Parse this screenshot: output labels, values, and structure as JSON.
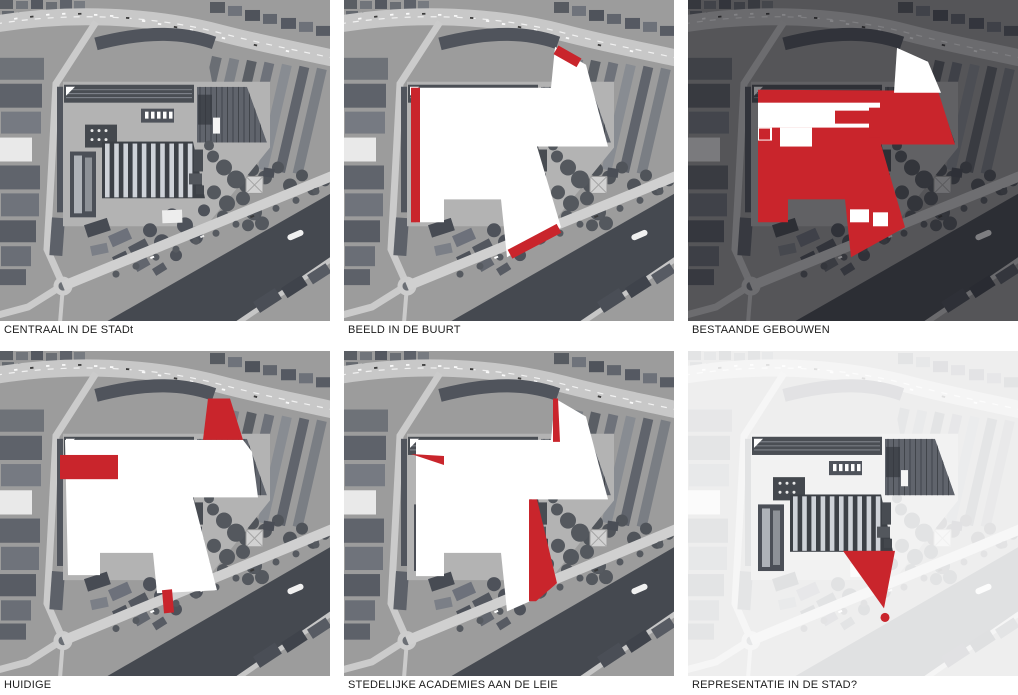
{
  "sheet": {
    "title": "site analysis aerial diagrams",
    "background": "#ffffff",
    "grid": {
      "columns": 3,
      "rows": 2
    }
  },
  "colors": {
    "accent_red": "#c9252c",
    "photo_gray": "#9c9c9c",
    "river_dark": "#454950",
    "dark_veil": "#15161a",
    "caption_text": "#1d1d1d",
    "site_white": "#ffffff"
  },
  "panels": [
    {
      "caption": "CENTRAAL IN DE STADt",
      "style": "plain aerial photo"
    },
    {
      "caption": "BEELD IN DE BUURT",
      "style": "aerial photo with white site massing and red edge accents"
    },
    {
      "caption": "BESTAANDE GEBOUWEN",
      "style": "darkened aerial photo with existing buildings filled red and white courtyards"
    },
    {
      "caption": "HUIDIGE",
      "style": "aerial photo with white site massing and red building blocks"
    },
    {
      "caption": "STEDELIJKE ACADEMIES AAN DE LEIE",
      "style": "aerial photo with white site massing and red wedges toward the river"
    },
    {
      "caption": "REPRESENTATIE IN DE STAD?",
      "style": "faded aerial photo with dark existing buildings and red view cone with dot on the quay"
    }
  ]
}
